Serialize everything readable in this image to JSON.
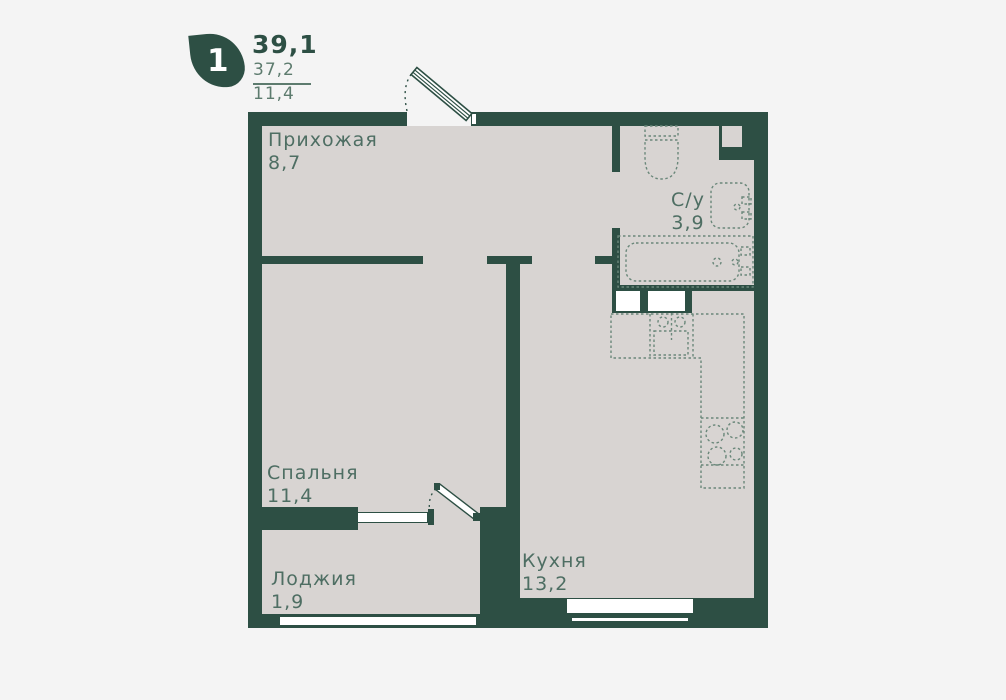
{
  "legend": {
    "rooms_count": "1",
    "total_area": "39,1",
    "living_area": "37,2",
    "kitchen_area": "11,4"
  },
  "rooms": {
    "hallway": {
      "name": "Прихожая",
      "area": "8,7"
    },
    "bathroom": {
      "name": "С/у",
      "area": "3,9"
    },
    "bedroom": {
      "name": "Спальня",
      "area": "11,4"
    },
    "loggia": {
      "name": "Лоджия",
      "area": "1,9"
    },
    "kitchen": {
      "name": "Кухня",
      "area": "13,2"
    }
  },
  "fixtures": {
    "entry_door": "entry-door",
    "balcony_door": "balcony-door",
    "toilet": "toilet",
    "washbasin": "washbasin",
    "bathtub": "bathtub",
    "kitchen_sink": "kitchen-sink",
    "stove": "stove-4-burners",
    "counter": "kitchen-counter"
  },
  "colors": {
    "wall": "#2d4f44",
    "floor": "#d8d4d2",
    "background": "#f4f4f4",
    "fixture_outline": "#6a877a",
    "label_text": "#4e6e63",
    "window": "#ffffff",
    "legend_soft": "#5d7b6e"
  }
}
